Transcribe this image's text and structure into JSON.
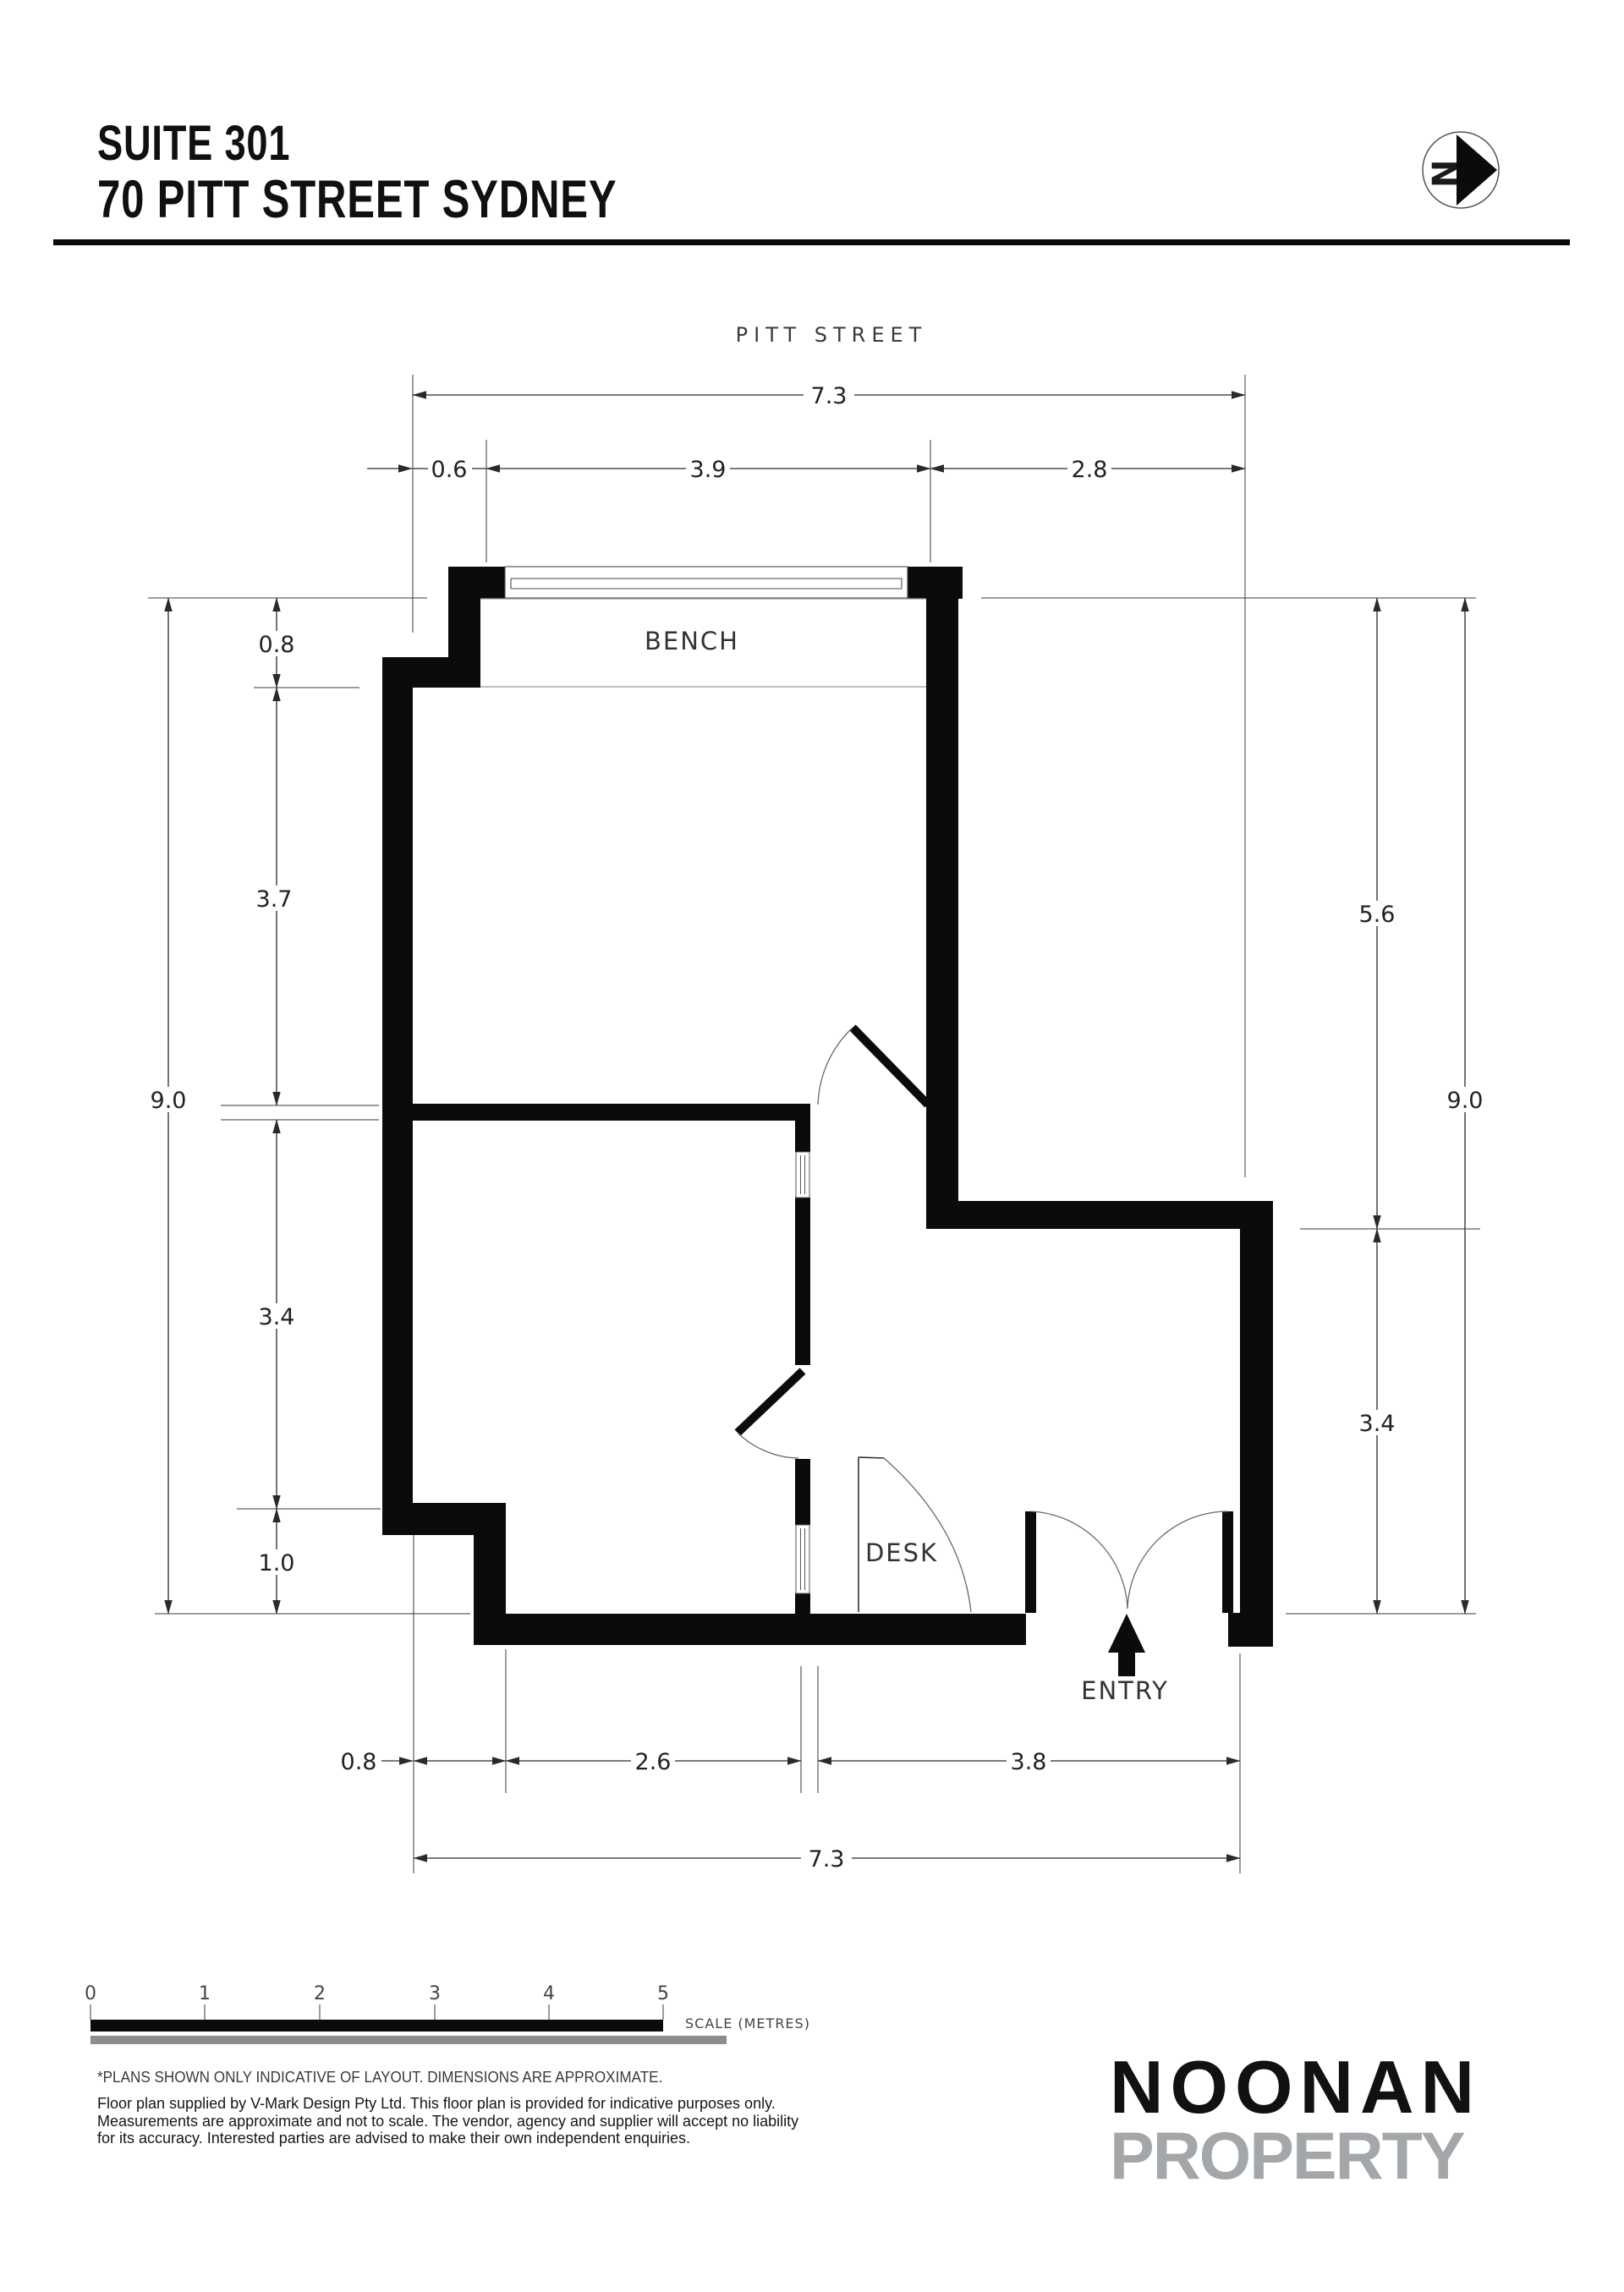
{
  "header": {
    "suite": "SUITE 301",
    "address": "70 PITT STREET SYDNEY"
  },
  "north_icon": {
    "letter": "N"
  },
  "plan": {
    "street_label": "PITT STREET",
    "rooms": {
      "bench": "BENCH",
      "desk": "DESK",
      "entry": "ENTRY"
    },
    "dimensions": {
      "top": {
        "overall": "7.3",
        "segments": [
          "0.6",
          "3.9",
          "2.8"
        ]
      },
      "left": {
        "overall": "9.0",
        "segments": [
          "0.8",
          "3.7",
          "3.4",
          "1.0"
        ]
      },
      "right": {
        "overall": "9.0",
        "segments": [
          "5.6",
          "3.4"
        ]
      },
      "bottom": {
        "overall": "7.3",
        "segments": [
          "0.8",
          "2.6",
          "3.8"
        ]
      }
    }
  },
  "scale_bar": {
    "ticks": [
      "0",
      "1",
      "2",
      "3",
      "4",
      "5"
    ],
    "label": "SCALE (METRES)"
  },
  "disclaimer": {
    "line1": "*PLANS SHOWN ONLY INDICATIVE OF LAYOUT. DIMENSIONS ARE APPROXIMATE.",
    "body": [
      "Floor plan supplied by V-Mark Design Pty Ltd. This floor plan is provided for indicative purposes only.",
      "Measurements are approximate and not to scale. The vendor, agency and supplier will accept no liability",
      "for its accuracy. Interested parties are advised to make their own independent enquiries."
    ]
  },
  "logo": {
    "name": "NOONAN",
    "type": "PROPERTY"
  },
  "colors": {
    "wall": "#0b0b0b",
    "scale_bar_black": "#0b0b0b",
    "scale_bar_gray": "#8d8d8d",
    "logo_gray": "#a4a7aa"
  }
}
